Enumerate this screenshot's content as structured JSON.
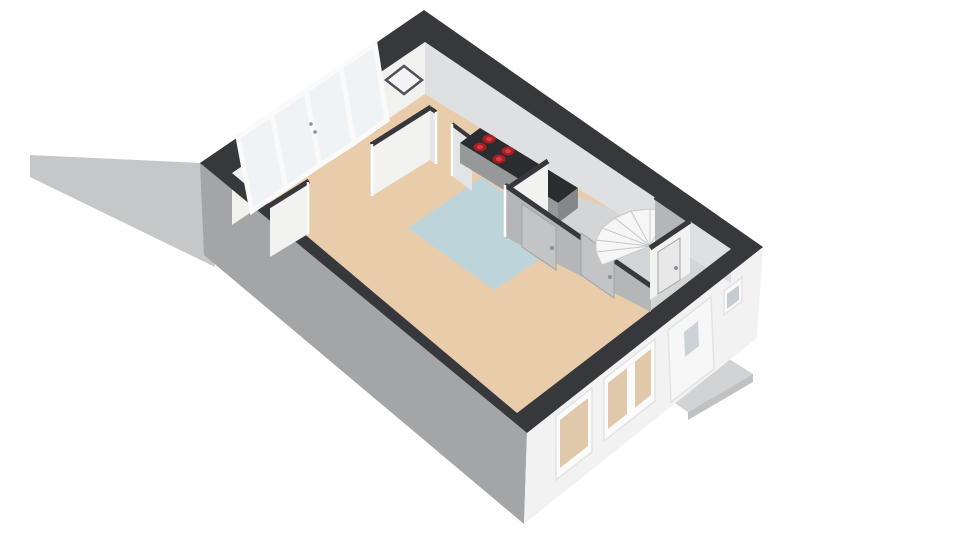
{
  "canvas": {
    "width": 960,
    "height": 540,
    "background": "#ffffff"
  },
  "colors": {
    "wall_top": "#37383c",
    "exterior_wall_shaded": "#a4a5a7",
    "exterior_wall_lit": "#f2f2f3",
    "interior_wall_lit": "#f2f2f1",
    "interior_wall_shaded": "#b5b6b8",
    "interior_wall_soft": "#e3e4e5",
    "interior_face_nw": "#f1f1f0",
    "interior_face_ne": "#dfe0e1",
    "floor_wood": "#e9cdaa",
    "floor_kitchen": "#bdd5da",
    "floor_hall": "#d4d5d6",
    "ground_shadow": "#c6c7c8",
    "doorstep": "#d2d3d4",
    "doorstep_edge": "#c0c1c2",
    "stair_tread": "#f6f6f7",
    "counter_top": "#2b2c2f",
    "counter_body": "#97989a",
    "counter_side": "#86878a",
    "burner_red": "#a81e23",
    "burner_red_inner": "#d43a40",
    "window_glass": "#eff3f5",
    "window_view_floor": "#e0c9ab",
    "door_panel": "#f7f7f8",
    "door_glass": "#ccd3d6",
    "toilet_glass": "#c5ccd0",
    "mirror_glass": "#f2f4f6",
    "hall_door_panel": "#c3c4c6",
    "toilet_door_panel": "#e8e8e9"
  },
  "floorplan": {
    "view": "3D floor plan, ground floor, isometric bird view",
    "rooms": [
      "living-room",
      "dining-room",
      "kitchen",
      "hallway",
      "toilet"
    ],
    "features": {
      "french_window_panels": 4,
      "french_window_handles": 2,
      "wall_mirror_shape": "diamond",
      "cooktop_burners": 4,
      "staircase_type": "winding",
      "stair_steps": 8,
      "hall_interior_doors": 2,
      "toilet_doors": 1,
      "facade_windows": 2,
      "front_doors": 1,
      "front_door_panes": 1,
      "toilet_windows": 1,
      "doorsteps": 1
    }
  }
}
